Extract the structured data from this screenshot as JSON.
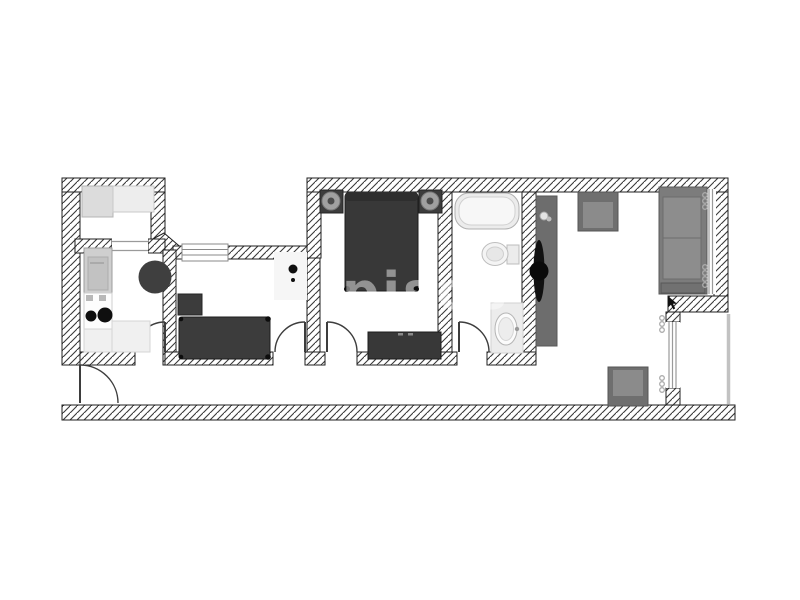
{
  "watermark": {
    "text": "pisos"
  },
  "plan": {
    "type": "apartment-floor-plan",
    "palette": {
      "background": "#ffffff",
      "wall_outline": "#1f1f1f",
      "hatch_line": "#3a3a3a",
      "dark_furniture": "#3a3a3a",
      "mid_furniture": "#7a7a7a",
      "light_furniture": "#ececec",
      "window_line": "#9a9a9a",
      "railing": "#c2c2c2",
      "watermark_color": "#ffffff"
    },
    "rooms": [
      {
        "name": "storage-room",
        "items": [
          "cabinet-left",
          "cabinet-right"
        ]
      },
      {
        "name": "kitchen",
        "items": [
          "appliance-column",
          "stove-with-burners",
          "counter-left",
          "counter-bottom",
          "round-dining-table"
        ]
      },
      {
        "name": "bedroom-single",
        "items": [
          "single-bed",
          "nightstand",
          "floor-lamp",
          "rug",
          "window"
        ]
      },
      {
        "name": "bedroom-double",
        "items": [
          "double-bed",
          "nightstand-left",
          "table-lamp-left",
          "nightstand-right",
          "table-lamp-right",
          "dresser"
        ]
      },
      {
        "name": "bathroom",
        "items": [
          "bathtub",
          "toilet",
          "sink-vanity"
        ]
      },
      {
        "name": "living-room",
        "items": [
          "tv-cabinet",
          "tv",
          "decor-object",
          "armchair-top",
          "armchair-bottom",
          "sofa",
          "curtains",
          "window"
        ]
      },
      {
        "name": "hallway",
        "items": [
          "entry-door"
        ]
      },
      {
        "name": "balcony",
        "items": [
          "railing",
          "glass-door"
        ]
      }
    ],
    "doors": [
      "entry-door",
      "kitchen-door",
      "single-bedroom-door",
      "double-bedroom-door",
      "bathroom-door"
    ],
    "windows": [
      "single-bedroom-window",
      "living-room-window",
      "balcony-window"
    ]
  }
}
